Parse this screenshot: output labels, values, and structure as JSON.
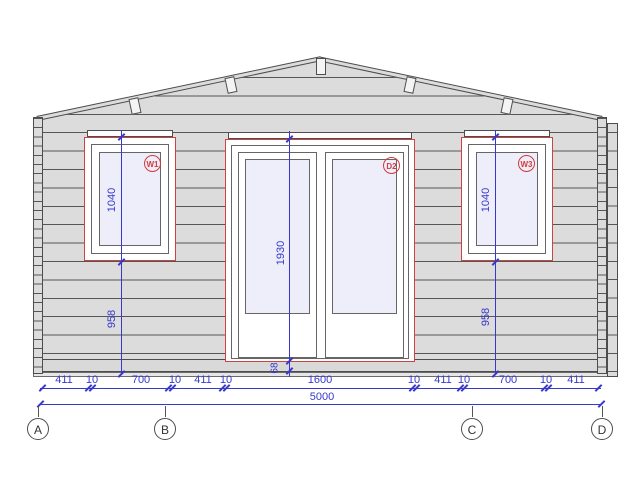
{
  "drawing": {
    "openings": {
      "w1": {
        "label": "W1",
        "height": "1040",
        "sill": "958"
      },
      "d2": {
        "label": "D2",
        "height": "1930",
        "threshold": "68"
      },
      "w3": {
        "label": "W3",
        "height": "1040",
        "sill": "958"
      }
    },
    "chain": [
      "411",
      "10",
      "700",
      "10",
      "411",
      "10",
      "1600",
      "10",
      "411",
      "10",
      "700",
      "10",
      "411"
    ],
    "total_width": "5000",
    "grid_axes": [
      "A",
      "B",
      "C",
      "D"
    ],
    "colors": {
      "dimension_blue": "#3838cc",
      "opening_red": "#cf4242",
      "wall_fill": "#dcdcdc",
      "glass_fill": "#eeeefb",
      "beam_fill": "#d9d9d9",
      "line_dark": "#4d4d4d"
    }
  }
}
